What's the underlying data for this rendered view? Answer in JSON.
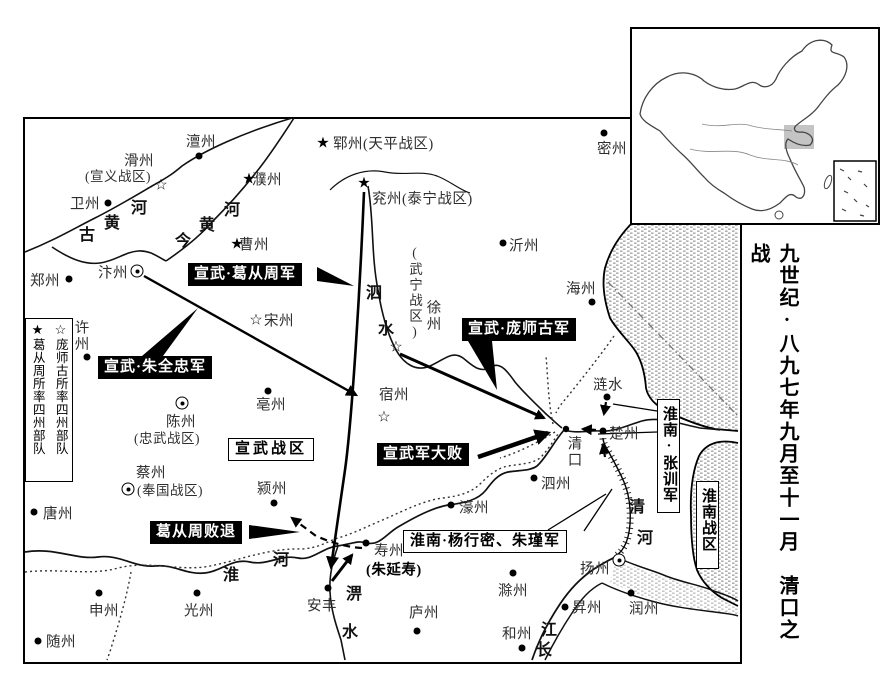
{
  "title": "九世纪·八九七年九月至十一月　清口之战",
  "symbols": {
    "star_black": "★",
    "star_white": "☆"
  },
  "legend": {
    "black_star": "★",
    "black_star_label": "葛从周所率四州部队",
    "white_star": "☆",
    "white_star_label": "庞师古所率四州部队"
  },
  "places": {
    "chanzhou": {
      "name": "澶州"
    },
    "huazhou": {
      "name": "滑州",
      "note": "(宣义战区)"
    },
    "weizhou": {
      "name": "卫州"
    },
    "zhengzhou": {
      "name": "郑州"
    },
    "bianzhou": {
      "name": "汴州"
    },
    "xuzhou_xu": {
      "name": "许州"
    },
    "puzhou": {
      "name": "濮州"
    },
    "caozhou": {
      "name": "曹州"
    },
    "yunzhou": {
      "name": "郓州(天平战区)"
    },
    "yanzhou": {
      "name": "兖州(泰宁战区)"
    },
    "songzhou": {
      "name": "宋州"
    },
    "bozhou": {
      "name": "亳州"
    },
    "chenzhou": {
      "name": "陈州",
      "note": "(忠武战区)"
    },
    "caizhou": {
      "name": "蔡州",
      "note": "(奉国战区)"
    },
    "yingzhou": {
      "name": "颍州"
    },
    "tangzhou": {
      "name": "唐州"
    },
    "shenzhou": {
      "name": "申州"
    },
    "suizhou": {
      "name": "随州"
    },
    "guangzhou": {
      "name": "光州"
    },
    "anfeng": {
      "name": "安丰"
    },
    "shouzhou": {
      "name": "寿州",
      "note": "(朱延寿)"
    },
    "luzhou": {
      "name": "庐州"
    },
    "hezhou": {
      "name": "和州"
    },
    "chuzhou_chu": {
      "name": "滁州"
    },
    "yangzhou": {
      "name": "扬州"
    },
    "shengzhou": {
      "name": "昇州"
    },
    "runzhou": {
      "name": "润州"
    },
    "haozhou": {
      "name": "濠州"
    },
    "sizhou": {
      "name": "泗州"
    },
    "qingkou": {
      "name": "清口"
    },
    "chuzhou": {
      "name": "楚州"
    },
    "lianshui": {
      "name": "涟水"
    },
    "haizhou": {
      "name": "海州"
    },
    "yizhou": {
      "name": "沂州"
    },
    "mizhou": {
      "name": "密州"
    },
    "suzhou": {
      "name": "宿州"
    },
    "xuzhou": {
      "name": "徐州",
      "note": "(武宁战区)"
    }
  },
  "rivers": {
    "old_yellow": [
      "古",
      "黄",
      "河"
    ],
    "today_yellow": [
      "今",
      "黄",
      "河"
    ],
    "si": [
      "泗",
      "水"
    ],
    "huai": [
      "淮",
      "河"
    ],
    "pi": [
      "淠",
      "水"
    ],
    "qing": [
      "清",
      "河"
    ],
    "changjiang": [
      "江",
      "长"
    ]
  },
  "army_labels": {
    "ge": "宣武·葛从周军",
    "zhu": "宣武·朱全忠军",
    "pang": "宣武·庞师古军",
    "defeat": "宣武军大败",
    "retreat": "葛从周败退",
    "zhangxun": "淮南·张训军",
    "yangzhu": "淮南·杨行密、朱瑾军"
  },
  "zones": {
    "xuanwu": "宣武战区",
    "huainan": "淮南战区"
  }
}
